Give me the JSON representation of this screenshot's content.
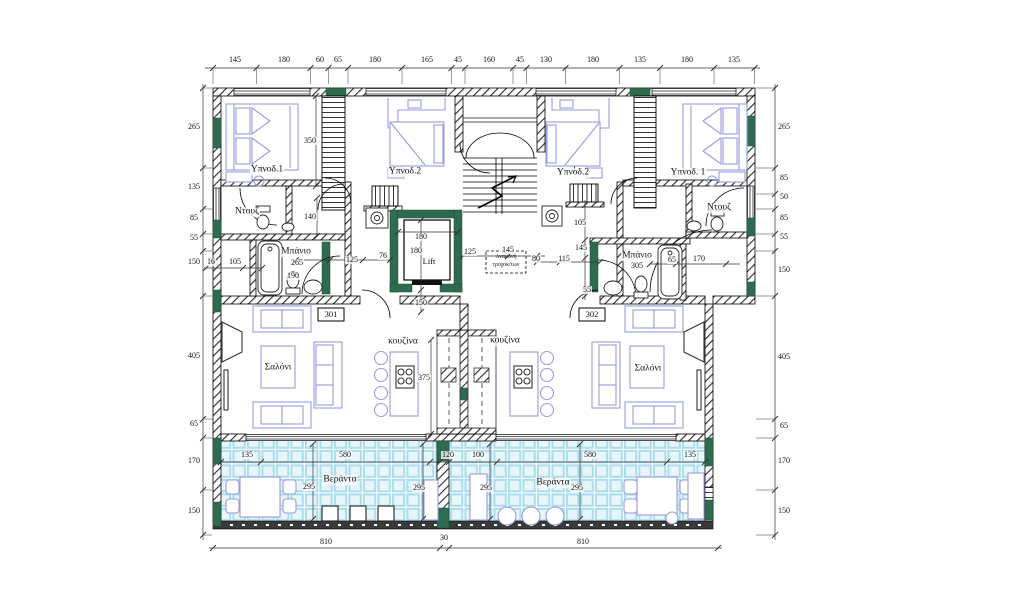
{
  "plan": {
    "unit_numbers": [
      "301",
      "302"
    ],
    "room_names": [
      "Υπνοδ.1",
      "Υπνοδ.2",
      "Ντουζ",
      "Μπάνιο",
      "Σαλόνι",
      "κουζίνα",
      "Βεράντα",
      "Lift"
    ],
    "note_box": {
      "x": 506,
      "y1": 258,
      "y2": 266,
      "lines": [
        "Αναμονή",
        "τροχοκ/των"
      ]
    }
  },
  "colors": {
    "column_green": "#2e6b50",
    "furniture_purple": "#9a9ade",
    "tile_line": "#a9dded",
    "tile_fill": "#e8f6fa",
    "wall_dark": "#3a3a3a"
  },
  "labels": {
    "dims_top": [
      {
        "x": 235,
        "y": 60,
        "t": "145"
      },
      {
        "x": 284,
        "y": 60,
        "t": "180"
      },
      {
        "x": 320,
        "y": 60,
        "t": "60"
      },
      {
        "x": 338,
        "y": 60,
        "t": "65"
      },
      {
        "x": 375,
        "y": 60,
        "t": "180"
      },
      {
        "x": 427,
        "y": 60,
        "t": "165"
      },
      {
        "x": 458,
        "y": 60,
        "t": "45"
      },
      {
        "x": 489,
        "y": 60,
        "t": "160"
      },
      {
        "x": 520,
        "y": 60,
        "t": "45"
      },
      {
        "x": 546,
        "y": 60,
        "t": "130"
      },
      {
        "x": 593,
        "y": 60,
        "t": "180"
      },
      {
        "x": 640,
        "y": 60,
        "t": "135"
      },
      {
        "x": 687,
        "y": 60,
        "t": "180"
      },
      {
        "x": 734,
        "y": 60,
        "t": "135"
      }
    ],
    "dims_left": [
      {
        "x": 194,
        "y": 127,
        "t": "265"
      },
      {
        "x": 194,
        "y": 187,
        "t": "135"
      },
      {
        "x": 194,
        "y": 218,
        "t": "85"
      },
      {
        "x": 194,
        "y": 238,
        "t": "55"
      },
      {
        "x": 194,
        "y": 262,
        "t": "150"
      },
      {
        "x": 194,
        "y": 356,
        "t": "405"
      },
      {
        "x": 194,
        "y": 424,
        "t": "65"
      },
      {
        "x": 194,
        "y": 461,
        "t": "170"
      },
      {
        "x": 194,
        "y": 511,
        "t": "150"
      }
    ],
    "dims_right": [
      {
        "x": 784,
        "y": 127,
        "t": "265"
      },
      {
        "x": 784,
        "y": 178,
        "t": "85"
      },
      {
        "x": 784,
        "y": 197,
        "t": "50"
      },
      {
        "x": 784,
        "y": 218,
        "t": "85"
      },
      {
        "x": 784,
        "y": 237,
        "t": "55"
      },
      {
        "x": 784,
        "y": 270,
        "t": "150"
      },
      {
        "x": 784,
        "y": 357,
        "t": "405"
      },
      {
        "x": 784,
        "y": 426,
        "t": "65"
      },
      {
        "x": 784,
        "y": 461,
        "t": "170"
      },
      {
        "x": 784,
        "y": 511,
        "t": "150"
      }
    ],
    "dims_bottom": [
      {
        "x": 326,
        "y": 542,
        "t": "810"
      },
      {
        "x": 444,
        "y": 538,
        "t": "30"
      },
      {
        "x": 583,
        "y": 542,
        "t": "810"
      }
    ],
    "dims_inner": [
      {
        "x": 310,
        "y": 141,
        "t": "350"
      },
      {
        "x": 310,
        "y": 217,
        "t": "140"
      },
      {
        "x": 211,
        "y": 262,
        "t": "16"
      },
      {
        "x": 235,
        "y": 262,
        "t": "105"
      },
      {
        "x": 297,
        "y": 263,
        "t": "265"
      },
      {
        "x": 293,
        "y": 276,
        "t": "190"
      },
      {
        "x": 352,
        "y": 260,
        "t": "125"
      },
      {
        "x": 383,
        "y": 256,
        "t": "76"
      },
      {
        "x": 421,
        "y": 237,
        "t": "180"
      },
      {
        "x": 416,
        "y": 251,
        "t": "180"
      },
      {
        "x": 421,
        "y": 303,
        "t": "150"
      },
      {
        "x": 470,
        "y": 252,
        "t": "125"
      },
      {
        "x": 508,
        "y": 250,
        "t": "145"
      },
      {
        "x": 536,
        "y": 259,
        "t": "80"
      },
      {
        "x": 564,
        "y": 259,
        "t": "115"
      },
      {
        "x": 580,
        "y": 223,
        "t": "105"
      },
      {
        "x": 581,
        "y": 248,
        "t": "145"
      },
      {
        "x": 587,
        "y": 290,
        "t": "55"
      },
      {
        "x": 637,
        "y": 266,
        "t": "305"
      },
      {
        "x": 672,
        "y": 260,
        "t": "65"
      },
      {
        "x": 699,
        "y": 259,
        "t": "170"
      },
      {
        "x": 424,
        "y": 378,
        "t": "375"
      },
      {
        "x": 247,
        "y": 455,
        "t": "135"
      },
      {
        "x": 345,
        "y": 455,
        "t": "580"
      },
      {
        "x": 448,
        "y": 455,
        "t": "120"
      },
      {
        "x": 478,
        "y": 455,
        "t": "100"
      },
      {
        "x": 590,
        "y": 455,
        "t": "580"
      },
      {
        "x": 690,
        "y": 455,
        "t": "135"
      },
      {
        "x": 309,
        "y": 487,
        "t": "295"
      },
      {
        "x": 419,
        "y": 488,
        "t": "295"
      },
      {
        "x": 486,
        "y": 488,
        "t": "295"
      },
      {
        "x": 577,
        "y": 488,
        "t": "295"
      }
    ],
    "rooms": [
      {
        "x": 267,
        "y": 170,
        "t": "Υπνοδ.1"
      },
      {
        "x": 405,
        "y": 172,
        "t": "Υπνοδ.2"
      },
      {
        "x": 573,
        "y": 173,
        "t": "Υπνοδ.2"
      },
      {
        "x": 688,
        "y": 173,
        "t": "Υπνοδ. 1"
      },
      {
        "x": 247,
        "y": 212,
        "t": "Ντουζ"
      },
      {
        "x": 719,
        "y": 208,
        "t": "Ντουζ"
      },
      {
        "x": 296,
        "y": 252,
        "t": "Μπάνιο"
      },
      {
        "x": 637,
        "y": 256,
        "t": "Μπάνιο"
      },
      {
        "x": 278,
        "y": 368,
        "t": "Σαλόνι"
      },
      {
        "x": 648,
        "y": 369,
        "t": "Σαλόνι"
      },
      {
        "x": 403,
        "y": 342,
        "t": "κουζίνα"
      },
      {
        "x": 505,
        "y": 341,
        "t": "κουζίνα"
      },
      {
        "x": 340,
        "y": 480,
        "t": "Βεράντα"
      },
      {
        "x": 553,
        "y": 483,
        "t": "Βεράντα"
      }
    ],
    "lift": [
      {
        "x": 429,
        "y": 261,
        "t": "Lift"
      }
    ],
    "units": [
      {
        "x": 331,
        "y": 314,
        "t": "301"
      },
      {
        "x": 592,
        "y": 314,
        "t": "302"
      }
    ]
  }
}
